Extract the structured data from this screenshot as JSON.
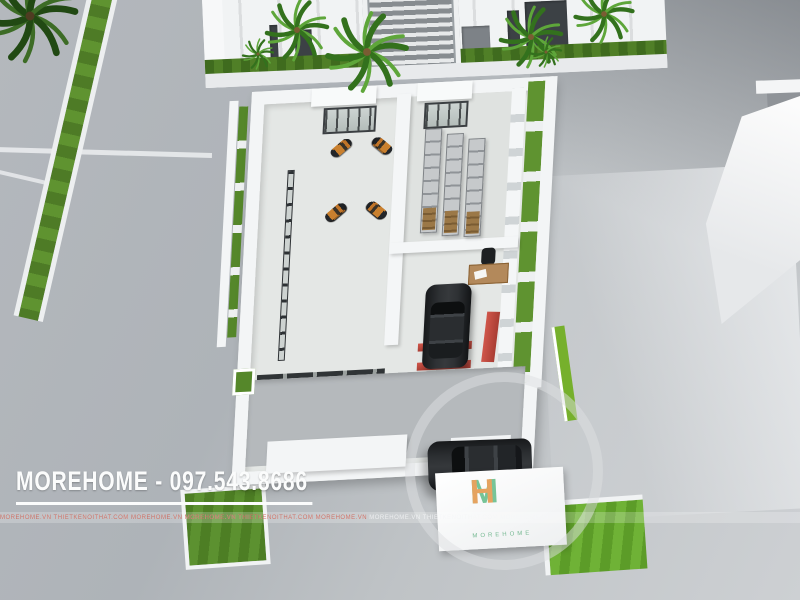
{
  "watermark": {
    "label": "MOREHOME - 097.543.8686"
  },
  "banner": {
    "text": "MOREHOME.VN   THIETKENOITHAT.COM  MOREHOME.VN",
    "left_repeats": 3,
    "right_repeats": 2
  },
  "logo": {
    "m": "M",
    "h": "H",
    "subtext": "MOREHOME"
  },
  "colors": {
    "asphalt": "#aeb3b8",
    "building_white": "#f3f5f6",
    "grass_green": "#5f9330",
    "bright_grass": "#6fb236",
    "bike_orange": "#c9802e",
    "suv_black": "#2c2f32",
    "lift_red": "#c34a3e",
    "shelf_gray": "#9b9fa4",
    "logo_green": "#76c498",
    "logo_orange": "#e5a360"
  },
  "scene": {
    "description": "Aerial 3D render of a motorcycle showroom floor plan with workshop, parts shelves, indoor car lift and outdoor SUV",
    "bike_rows_upper": 4,
    "bike_rows_lower": 9,
    "shelf_columns": 3,
    "palms": [
      {
        "x": 30,
        "y": 16,
        "s": 1.5,
        "dark": true
      },
      {
        "x": 297,
        "y": 30,
        "s": 1.0
      },
      {
        "x": 367,
        "y": 52,
        "s": 1.3
      },
      {
        "x": 258,
        "y": 54,
        "s": 0.5
      },
      {
        "x": 531,
        "y": 37,
        "s": 1.0
      },
      {
        "x": 604,
        "y": 14,
        "s": 0.95
      },
      {
        "x": 546,
        "y": 52,
        "s": 0.5
      }
    ],
    "objects": [
      "showroom-motorcycles",
      "parts-shelves",
      "office-desk",
      "car-lift",
      "suv-indoor",
      "suv-outdoor",
      "palm-trees",
      "grass-planters"
    ]
  }
}
